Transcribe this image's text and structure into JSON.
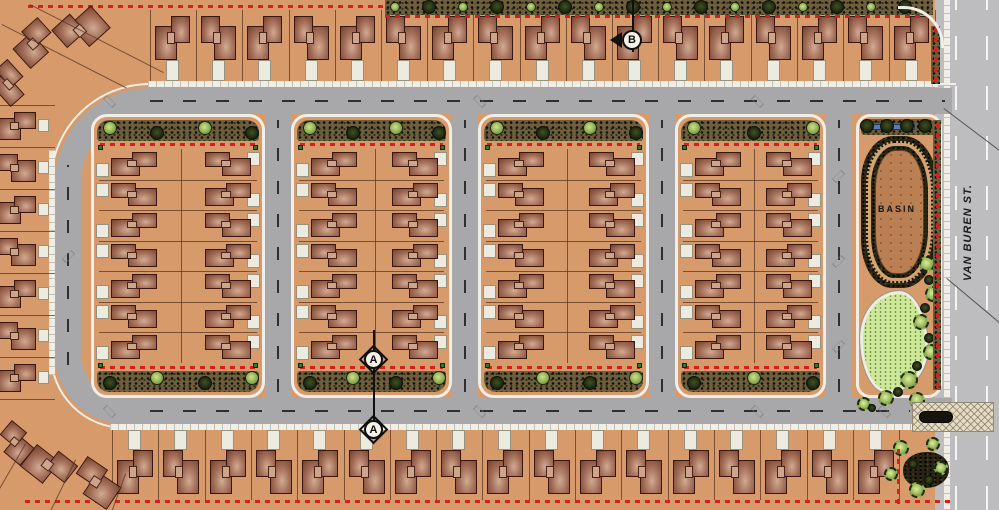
{
  "drawing": {
    "type": "residential-subdivision-site-plan",
    "labels": {
      "basin": "BASIN",
      "van_buren_street": "VAN BUREN ST.",
      "section_marker_a": "A",
      "section_marker_b": "B"
    },
    "features": {
      "residential_blocks": 4,
      "lot_rows_per_block_column": 7,
      "block_columns": 2,
      "top_row_lots": 17,
      "bottom_row_lots": 17,
      "west_edge_lots": 7,
      "retention_basin": true,
      "park_with_turf_area": true,
      "entry_paving_at_van_buren": true
    },
    "colors": {
      "lot_tan": "#d79a6b",
      "house_dark": "#73412e",
      "house_light": "#d2aa92",
      "house_outline": "#39170e",
      "street_gray": "#a8a8aa",
      "van_buren_gray": "#bdbdbf",
      "sidewalk": "#f0eee7",
      "landscape_dark": "#3a3222",
      "tree_green": "#8fae53",
      "turf_green": "#cde898",
      "basin_floor": "#ba7f52",
      "boundary_red": "#d81f1f"
    }
  }
}
